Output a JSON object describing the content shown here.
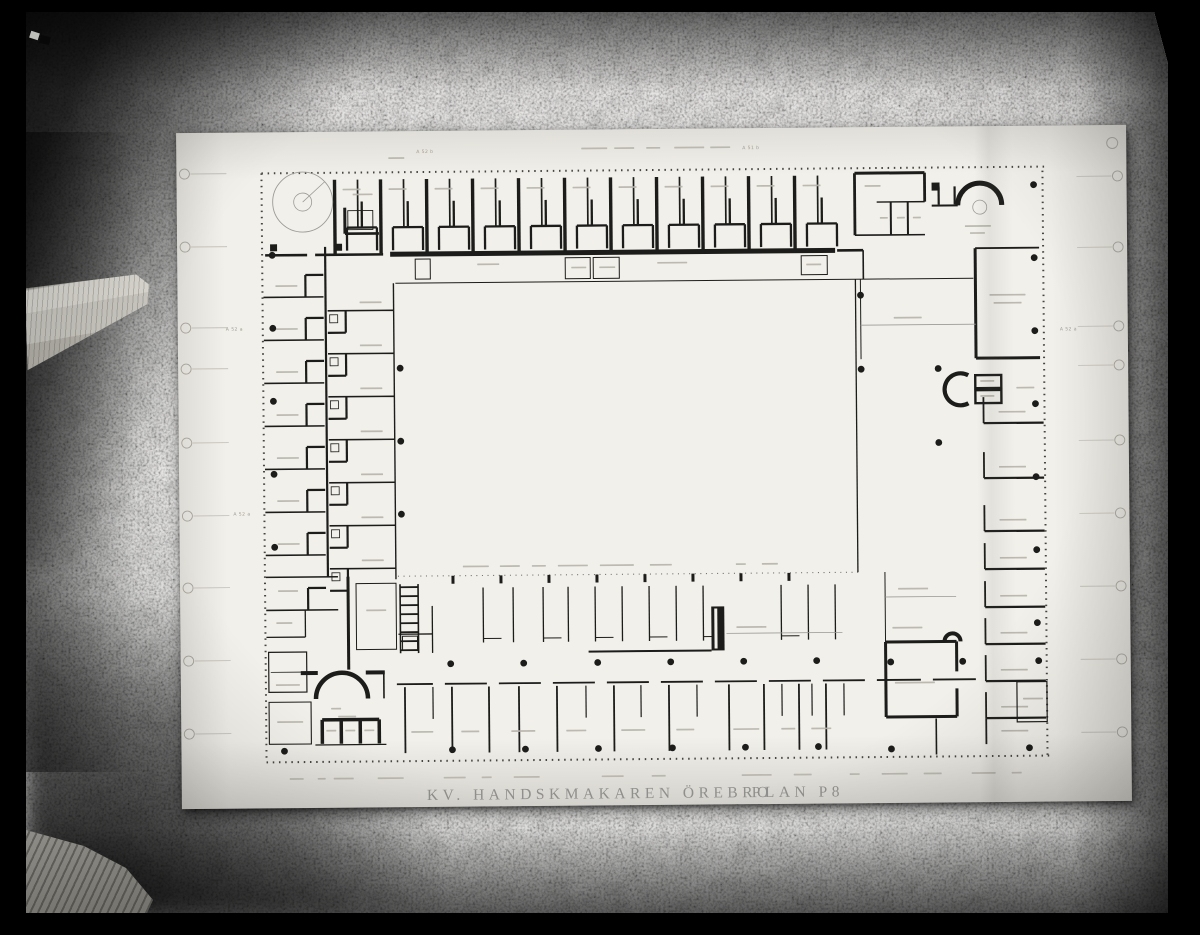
{
  "colors": {
    "backdrop": "#000000",
    "wall": "#8e8c88",
    "paper": "#f2f0ea",
    "ink": "#1c1c1a",
    "pencil": "#8f8f8d",
    "faint_note": "#a19d94"
  },
  "drawing": {
    "title": "KV. HANDSKMAKAREN ÖREBRO",
    "plan_label": "PLAN P8",
    "refs": {
      "top_left": "A 52 b",
      "top_center": "A 51 b",
      "left": "A 52 a",
      "right": "A 52 a",
      "bottom_left": "A 52 a"
    }
  }
}
